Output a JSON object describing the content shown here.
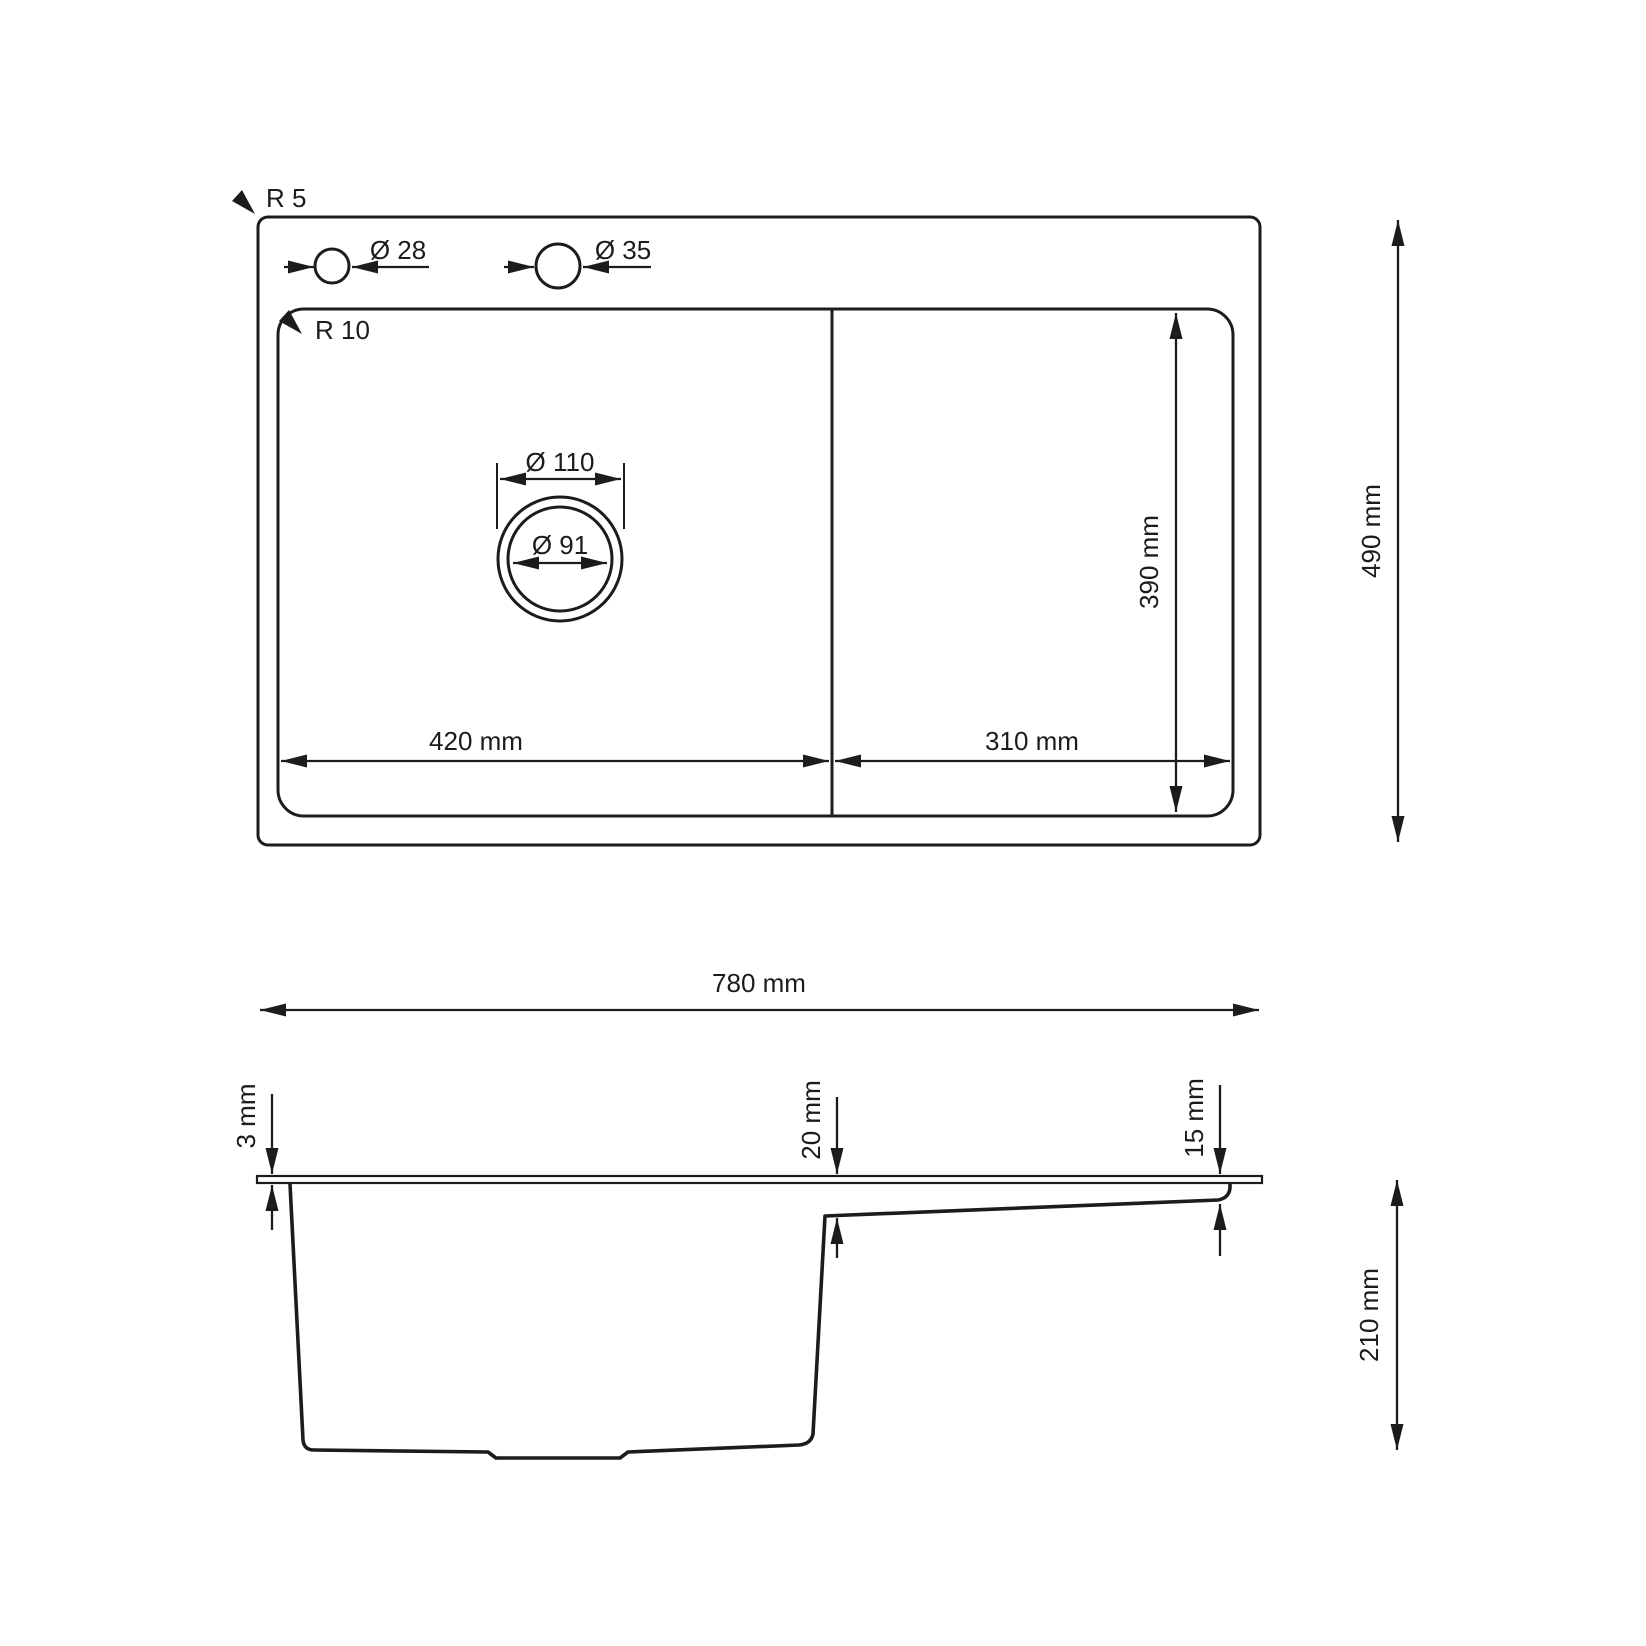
{
  "colors": {
    "line": "#1c1c1c",
    "background": "#ffffff"
  },
  "labels": {
    "top_view": {
      "outer_corner_radius": "R 5",
      "inner_corner_radius": "R 10",
      "faucet_hole_small": "Ø 28",
      "faucet_hole_large": "Ø 35",
      "drain_outer_diameter": "Ø 110",
      "drain_inner_diameter": "Ø 91",
      "bowl_width": "420 mm",
      "drainboard_width": "310 mm",
      "inner_depth": "390 mm",
      "overall_depth": "490 mm"
    },
    "side_view": {
      "overall_width": "780 mm",
      "rim_thickness": "3 mm",
      "step_depth_left": "20 mm",
      "step_depth_right": "15 mm",
      "bowl_height": "210 mm"
    }
  }
}
